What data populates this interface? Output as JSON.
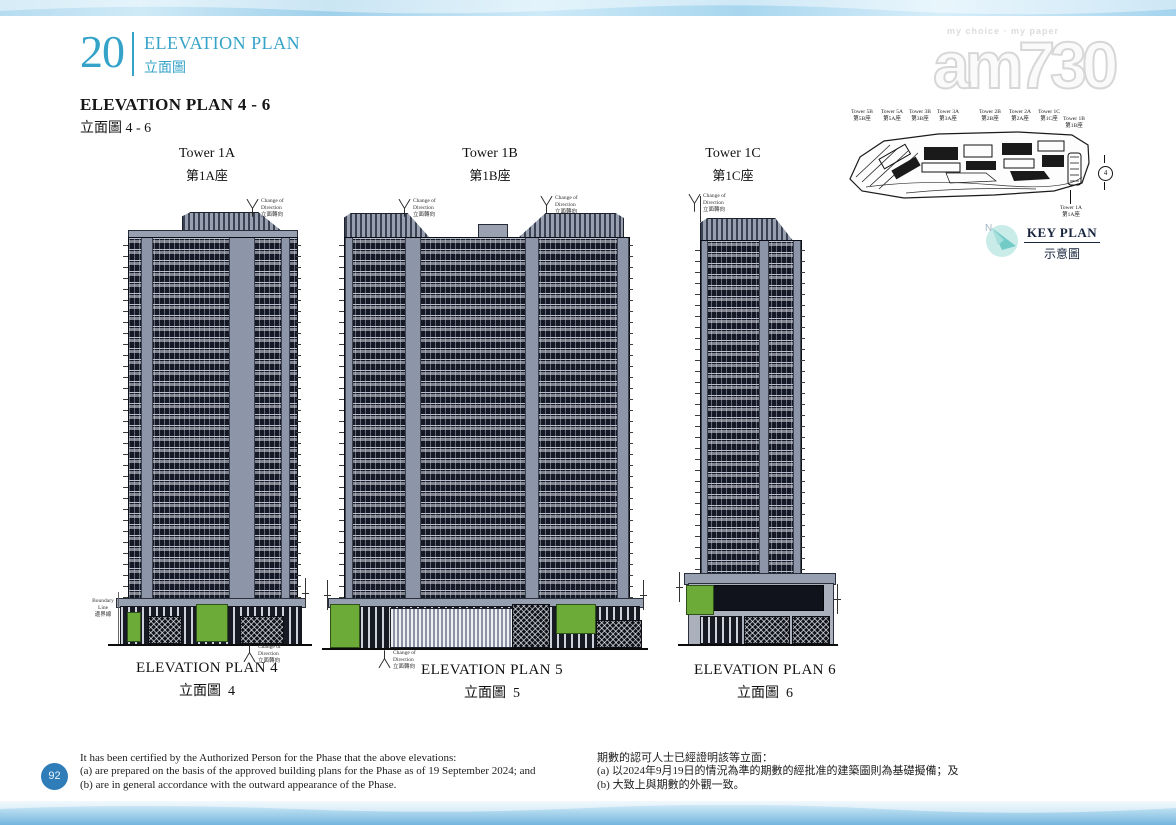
{
  "page": {
    "section_number": "20",
    "section_title_en": "ELEVATION PLAN",
    "section_title_zh": "立面圖",
    "heading_en": "ELEVATION PLAN 4 - 6",
    "heading_zh": "立面圖 4 - 6",
    "page_number": "92"
  },
  "watermark": {
    "tagline": "my choice · my paper",
    "logo": "am730"
  },
  "towers": [
    {
      "name_en": "Tower 1A",
      "name_zh": "第1A座",
      "plan_en": "ELEVATION PLAN 4",
      "plan_zh": "立面圖  4"
    },
    {
      "name_en": "Tower 1B",
      "name_zh": "第1B座",
      "plan_en": "ELEVATION PLAN 5",
      "plan_zh": "立面圖  5"
    },
    {
      "name_en": "Tower 1C",
      "name_zh": "第1C座",
      "plan_en": "ELEVATION PLAN 6",
      "plan_zh": "立面圖  6"
    }
  ],
  "annotations": {
    "change_of_direction_en": "Change of Direction",
    "change_of_direction_zh": "立面轉向",
    "boundary_line_en": "Boundary Line",
    "boundary_line_zh": "邊界線"
  },
  "key_plan": {
    "title_en": "KEY PLAN",
    "title_zh": "示意圖",
    "compass_n": "N",
    "marker": "4",
    "labels_top": [
      {
        "en": "Tower 5B",
        "zh": "第5B座"
      },
      {
        "en": "Tower 5A",
        "zh": "第5A座"
      },
      {
        "en": "Tower 3B",
        "zh": "第3B座"
      },
      {
        "en": "Tower 3A",
        "zh": "第3A座"
      },
      {
        "en": "Tower 2B",
        "zh": "第2B座"
      },
      {
        "en": "Tower 2A",
        "zh": "第2A座"
      },
      {
        "en": "Tower 1C",
        "zh": "第1C座"
      },
      {
        "en": "Tower 1B",
        "zh": "第1B座"
      }
    ],
    "label_bottom": {
      "en": "Tower 1A",
      "zh": "第1A座"
    }
  },
  "certification": {
    "en": [
      "It has been certified by the Authorized Person for the Phase that the above elevations:",
      "(a) are prepared on the basis of the approved building plans for the Phase as of 19 September 2024; and",
      "(b) are in general accordance with the outward appearance of the Phase."
    ],
    "zh": [
      "期數的認可人士已經證明該等立面：",
      "(a) 以2024年9月19日的情況為準的期數的經批准的建築圖則為基礎擬備；及",
      "(b) 大致上與期數的外觀一致。"
    ]
  },
  "colors": {
    "accent_teal": "#35a3c8",
    "badge_blue": "#2e7cb8",
    "facade_dark": "#151926",
    "facade_grey": "#8d96a8",
    "podium_green": "#6dab38",
    "wave_blue": "#a8d6ee"
  }
}
